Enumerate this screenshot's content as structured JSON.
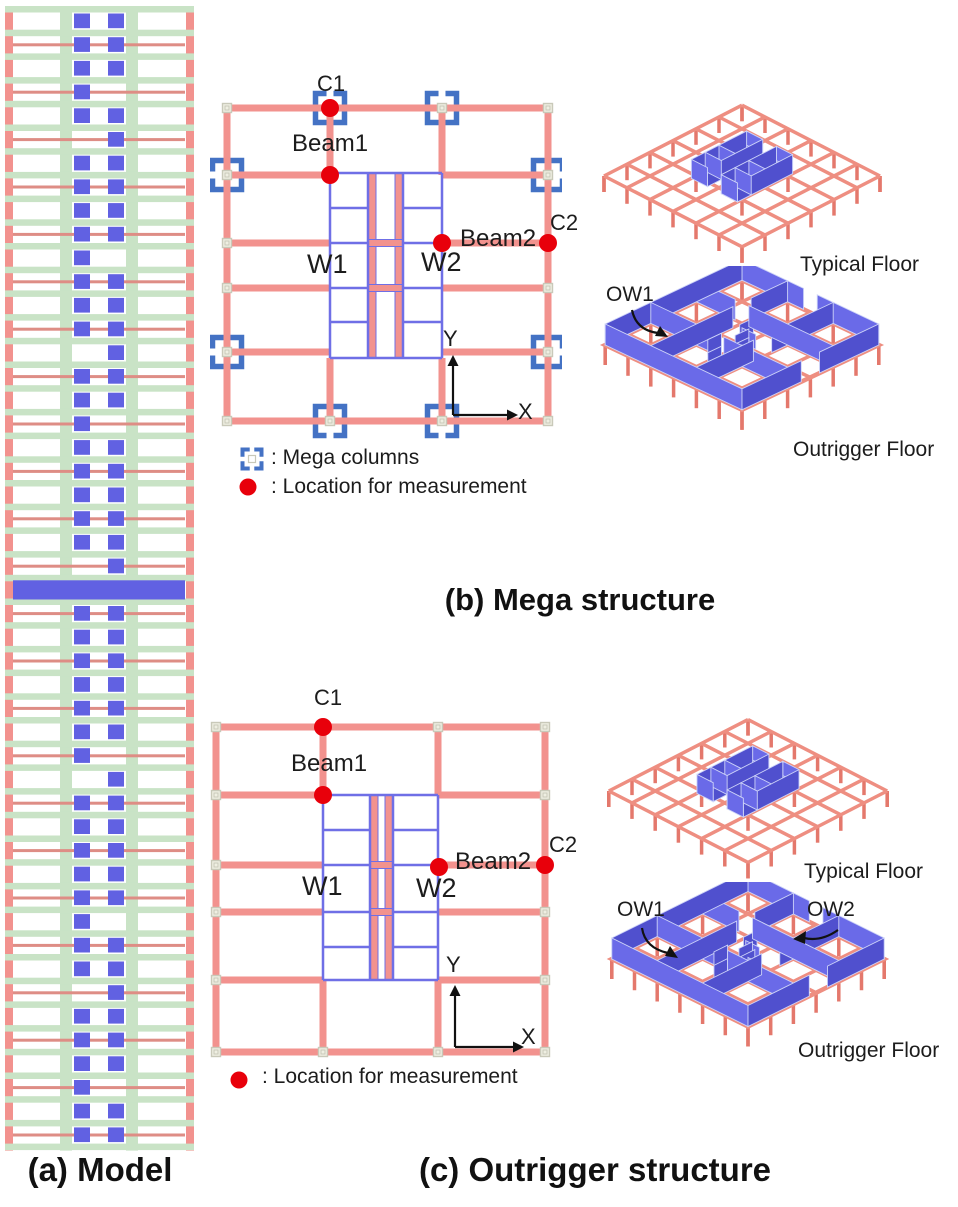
{
  "figure": {
    "panel_a": {
      "caption": "(a) Model"
    },
    "panel_b": {
      "caption": "(b) Mega structure",
      "plan": {
        "c1": "C1",
        "beam1": "Beam1",
        "beam2": "Beam2",
        "c2": "C2",
        "w1": "W1",
        "w2": "W2",
        "axis_x": "X",
        "axis_y": "Y"
      },
      "legend": {
        "mega_columns": ": Mega columns",
        "measurement": ": Location for measurement"
      },
      "views": {
        "typical": "Typical Floor",
        "outrigger": "Outrigger Floor",
        "ow1": "OW1"
      }
    },
    "panel_c": {
      "caption": "(c) Outrigger structure",
      "plan": {
        "c1": "C1",
        "beam1": "Beam1",
        "beam2": "Beam2",
        "c2": "C2",
        "w1": "W1",
        "w2": "W2",
        "axis_x": "X",
        "axis_y": "Y"
      },
      "legend": {
        "measurement": ": Location for measurement"
      },
      "views": {
        "typical": "Typical Floor",
        "outrigger": "Outrigger Floor",
        "ow1": "OW1",
        "ow2": "OW2"
      }
    },
    "colors": {
      "salmon": "#F2928E",
      "salmon_dark": "#E4786C",
      "beam3d": "#EE8E81",
      "slab_green": "#C9E3C6",
      "model_blue": "#6161E2",
      "model_beam_red": "#DE8D85",
      "core_blue": "#6F6FE6",
      "bracket_blue": "#4472C4",
      "dot_red": "#E8000B",
      "wall_light": "#6A6AE8",
      "wall_dark": "#5050CE",
      "wall_stroke": "#CDD3F8",
      "marker_gray": "#C9C9B9",
      "axis_black": "#111111"
    }
  }
}
